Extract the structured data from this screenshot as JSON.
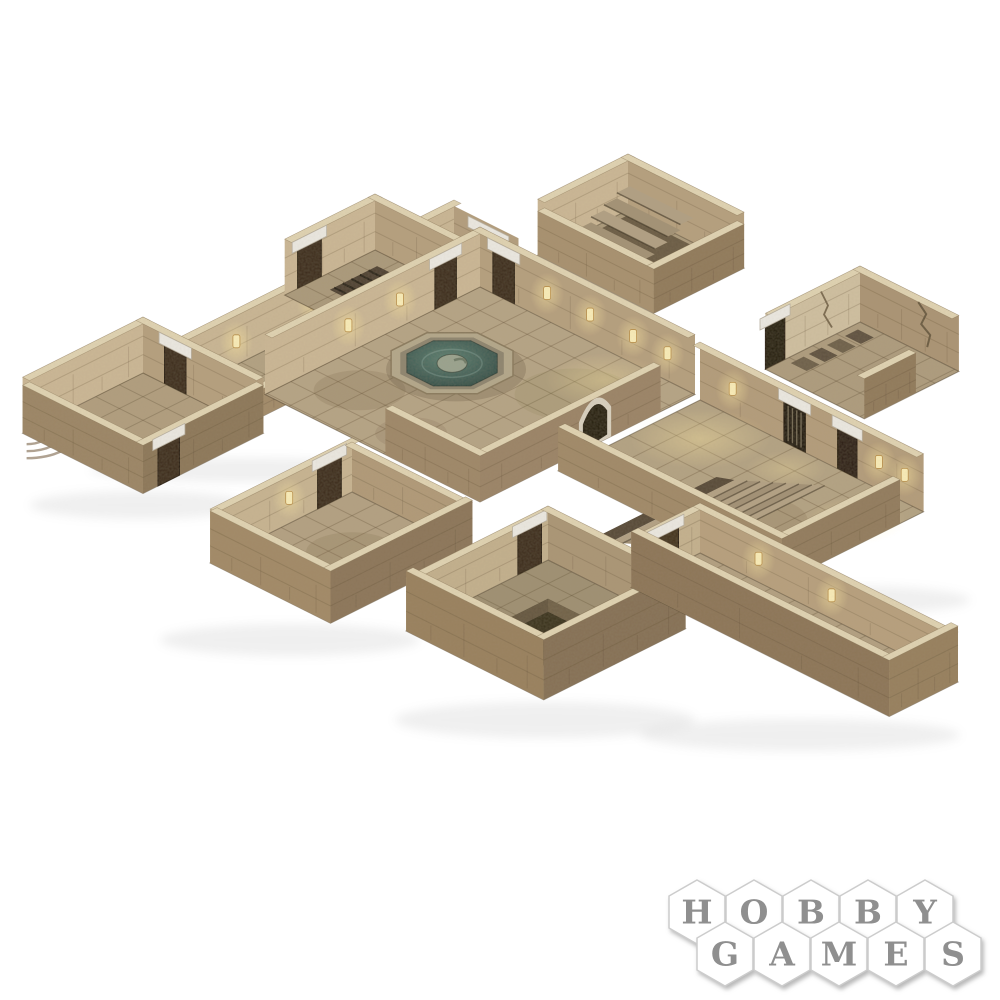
{
  "page": {
    "background": "#ffffff"
  },
  "product_image": {
    "alt": "Isometric cardboard dungeon terrain set: tiled stone rooms and corridors with a central courtyard and octagonal fountain, entry staircases, a hall with a wide sunken stair, a pit room with a metal grate, wooden doors with white stone lintels, glowing torch sconces and cracked walls",
    "elements": [
      "long-corridor",
      "curved-steps-room",
      "cell-room",
      "entry-stair-room",
      "courtyard",
      "fountain",
      "right-hall",
      "wide-staircase",
      "jail-door",
      "cracked-wall-room",
      "bottom-left-room",
      "pit-room",
      "pit-grate",
      "bottom-right-corridor",
      "torch-sconces",
      "arched-door"
    ]
  },
  "logo": {
    "name": "HOBBY GAMES",
    "row1": [
      "H",
      "O",
      "B",
      "B",
      "Y"
    ],
    "row2": [
      "G",
      "A",
      "M",
      "E",
      "S"
    ]
  },
  "palette": {
    "background": "#ffffff",
    "stone_light": "#e0d3b2",
    "wall_interior_lit": "#cbb795",
    "wall_interior_shade": "#b6a07f",
    "wall_exterior": "#9b8467",
    "floor": "#b4a284",
    "floor_dark": "#9f9073",
    "tile_line": "#56442c",
    "water": "#42635a",
    "door": "#3a2a1b",
    "lintel": "#ebe8e1",
    "torch_glow": "#ffe9a3",
    "pit": "#38301f",
    "logo_text": "#8f8f8f",
    "logo_hex_border": "#cccccc"
  }
}
